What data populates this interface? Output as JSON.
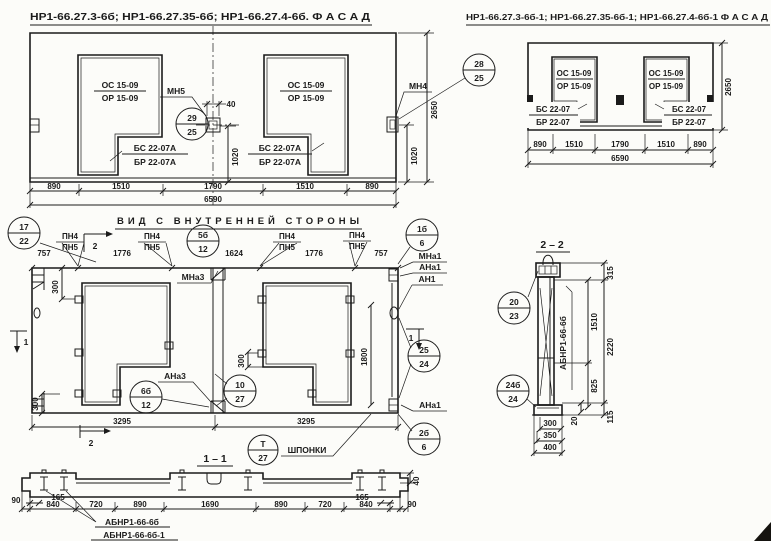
{
  "facade_main": {
    "title": "НР1-66.27.3-6б; НР1-66.27.35-6б; НР1-66.27.4-6б.  Ф А С А Д",
    "window_top": "ОС 15-09",
    "window_bottom": "ОР 15-09",
    "apron_top": "БС 22-07А",
    "apron_bottom": "БР 22-07А",
    "mark_mn5": "МН5",
    "mark_mn4": "МН4",
    "dim_40": "40",
    "dims_bottom": [
      "890",
      "1510",
      "1790",
      "1510",
      "890"
    ],
    "dim_total": "6590",
    "dim_1020_center": "1020",
    "dim_1020_right": "1020",
    "dim_2650": "2650",
    "c29_25": {
      "t": "29",
      "b": "25"
    },
    "c28_25": {
      "t": "28",
      "b": "25"
    }
  },
  "facade_mirrored": {
    "title": "НР1-66.27.3-6б-1; НР1-66.27.35-6б-1; НР1-66.27.4-6б-1  Ф А С А Д",
    "window_top": "ОС 15-09",
    "window_bottom": "ОР 15-09",
    "apron_top": "БС 22-07",
    "apron_bottom": "БР 22-07",
    "dims_bottom": [
      "890",
      "1510",
      "1790",
      "1510",
      "890"
    ],
    "dim_total": "6590",
    "dim_2650": "2650"
  },
  "inner_view": {
    "title": "ВИД С ВНУТРЕННЕЙ СТОРОНЫ",
    "mark_pn4": "ПН4",
    "mark_pn5": "ПН5",
    "dims_top": [
      "757",
      "1776",
      "1624",
      "1776",
      "757"
    ],
    "dim_300": "300",
    "dim_1800": "1800",
    "dim_3295": "3295",
    "mark_mna3": "МНа3",
    "mark_ana3": "АНа3",
    "mark_mna1": "МНа1",
    "mark_ana1": "АНа1",
    "mark_an1": "АН1",
    "sec_mark_1": "1",
    "sec_mark_2": "2",
    "keys_label": "ШПОНКИ",
    "c17_22": {
      "t": "17",
      "b": "22"
    },
    "c5b_12": {
      "t": "5б",
      "b": "12"
    },
    "c1b_6": {
      "t": "1б",
      "b": "6"
    },
    "c6b_12": {
      "t": "6б",
      "b": "12"
    },
    "c10_27": {
      "t": "10",
      "b": "27"
    },
    "c25_24": {
      "t": "25",
      "b": "24"
    },
    "c2b_6": {
      "t": "2б",
      "b": "6"
    },
    "cT_27": {
      "t": "Т",
      "b": "27"
    }
  },
  "section_1_1": {
    "title": "1 – 1",
    "dims_main": [
      "840",
      "720",
      "890",
      "1690",
      "890",
      "720",
      "840"
    ],
    "dim_90": "90",
    "dim_165": "165",
    "dim_40": "40",
    "brand_1": "АБНР1-66-6б",
    "brand_2": "АБНР1-66-6б-1"
  },
  "section_2_2": {
    "title": "2 – 2",
    "brand": "АБНР1-66-6б",
    "dim_315": "315",
    "dim_1510": "1510",
    "dim_2220": "2220",
    "dim_825": "825",
    "dim_20": "20",
    "dim_115": "115",
    "dims_bottom": [
      "300",
      "350",
      "400"
    ],
    "c20_23": {
      "t": "20",
      "b": "23"
    },
    "c24b_24": {
      "t": "24б",
      "b": "24"
    }
  }
}
